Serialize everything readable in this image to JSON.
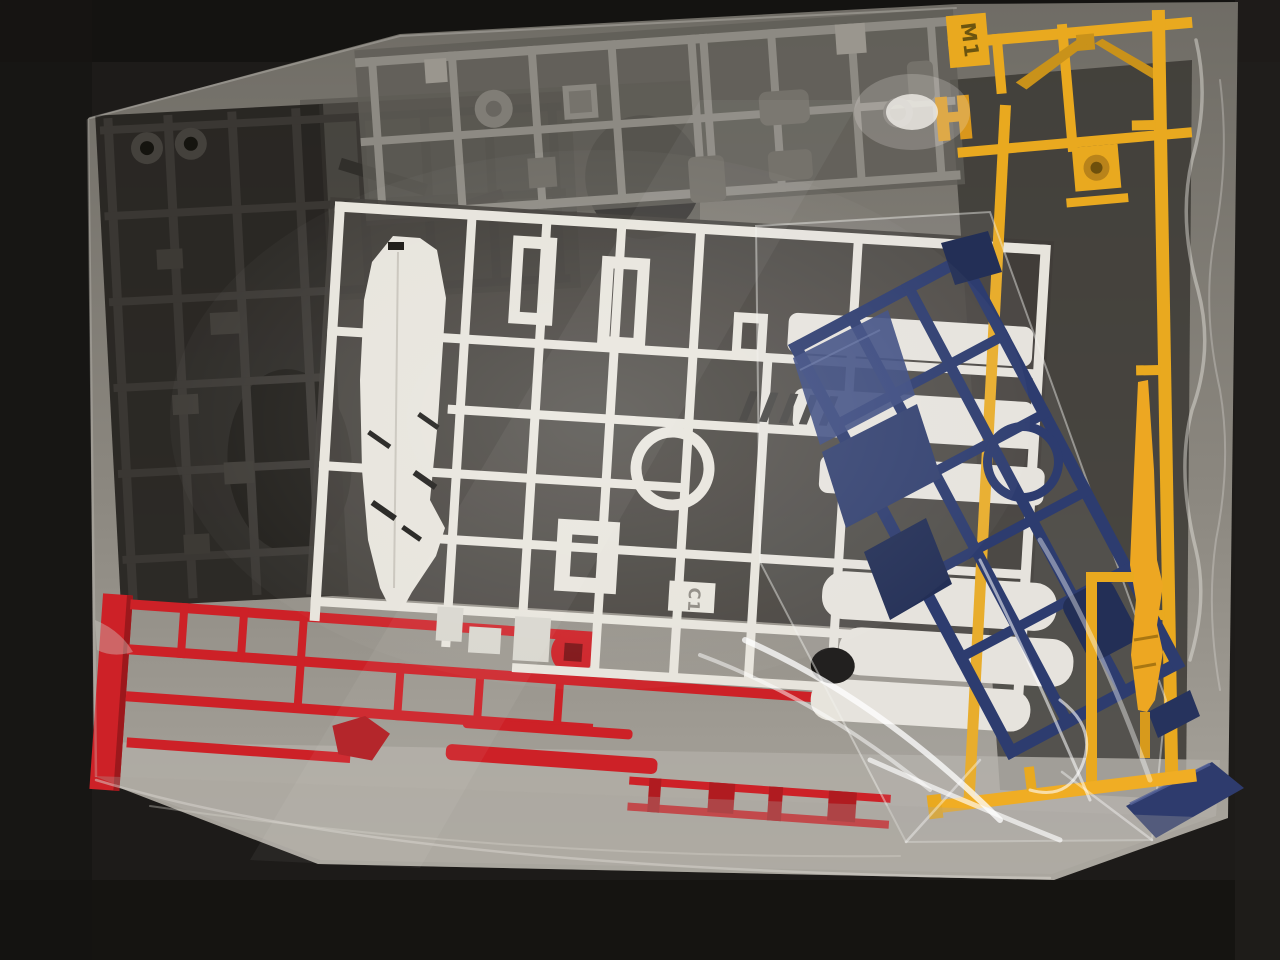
{
  "scene": {
    "description": "Photograph of plastic model kit part runners (sprues) sealed in a clear plastic bag lying on a dark textured mat",
    "bag_label": "clear parts bag",
    "inner_bag_label": "inner glossy bag holding navy runner"
  },
  "tags": {
    "yellow_runner": "M1",
    "white_runner": "C1"
  },
  "runners": {
    "white": "white armor runner",
    "grey": "grey inner-frame runner",
    "dark": "dark joint runner",
    "red": "red accent runner",
    "blue": "navy blue runner",
    "yellow": "yellow accent runner"
  },
  "colors": {
    "background": "#1d1b19",
    "mat_stripe": "#27241f",
    "bag_top": "#6f6c65",
    "bag_bottom": "#aba79f",
    "white_runner": "#e7e4dc",
    "grey_runner": "#8d8a83",
    "grey_part": "#757169",
    "dark_runner": "#3a3733",
    "red_runner": "#cd2127",
    "red_dark": "#9c181c",
    "blue_runner": "#2d3c6f",
    "blue_dark": "#232f56",
    "yellow_runner": "#e9a91f",
    "yellow_shadow": "#c9921a",
    "glare": "#f3f1ec"
  }
}
